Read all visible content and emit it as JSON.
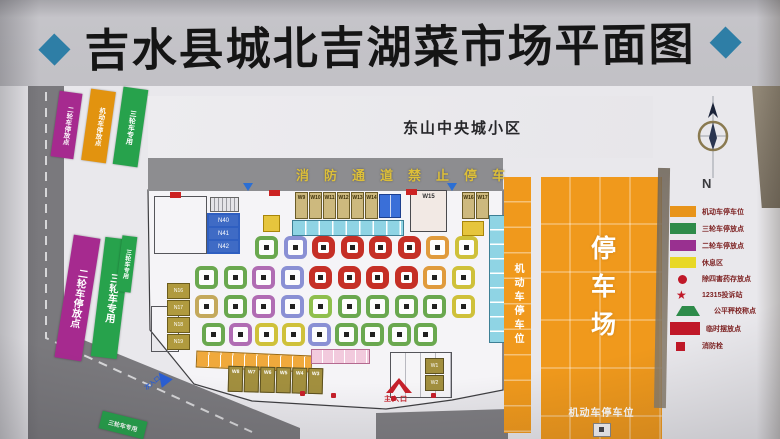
{
  "title": {
    "text": "吉水县城北吉湖菜市场平面图",
    "diamond": "◆"
  },
  "map": {
    "community_label": "东山中央城小区",
    "fire_lane_label": "消防通道禁止停车",
    "north_label": "N",
    "strips_top": [
      {
        "label": "二轮车停放点",
        "color": "#a62a8f"
      },
      {
        "label": "机动车停放点",
        "color": "#e2930f"
      },
      {
        "label": "三轮车专用",
        "color": "#27a24c"
      }
    ],
    "strips_mid": [
      {
        "label": "二轮车停放点",
        "color": "#a62a8f"
      },
      {
        "label": "三轮车专用",
        "color": "#27a24c"
      },
      {
        "label": "三轮车专用",
        "color": "#27a24c"
      }
    ],
    "road_strip_label": "三轮车专用",
    "right_strip_label": "机动车停车位",
    "parking_label": "停车场",
    "parking_bottom_label": "机动车停车位",
    "main_entrance": "主入口",
    "secondary_entrance": "次入口",
    "shops_top": [
      "W9",
      "W10",
      "W11",
      "W12",
      "W13",
      "W14"
    ],
    "room_big": "W15",
    "shops_right": [
      "W16",
      "W17"
    ],
    "block_blue": [
      "N40",
      "N41",
      "N42"
    ],
    "shops_left": [
      "N16",
      "N17",
      "N18",
      "N19"
    ],
    "shops_bottom": [
      "W8",
      "W7",
      "W6",
      "W5",
      "W4",
      "W3"
    ],
    "shops_bottom_right": [
      "W1",
      "W2"
    ]
  },
  "legend": {
    "items": [
      {
        "swatch": "rect",
        "color": "#e8941a",
        "label": "机动车停车位"
      },
      {
        "swatch": "rect",
        "color": "#2e8b4a",
        "label": "三轮车停放点"
      },
      {
        "swatch": "rect",
        "color": "#993090",
        "label": "二轮车停放点"
      },
      {
        "swatch": "rect",
        "color": "#e8d825",
        "label": "休息区"
      },
      {
        "swatch": "circle",
        "color": "#c01828",
        "label": "除四害药存放点"
      },
      {
        "swatch": "star",
        "color": "#c01828",
        "label": "12315投诉站"
      },
      {
        "swatch": "triangle",
        "color": "#2e8b4a",
        "label": "公平秤校称点"
      },
      {
        "swatch": "wide",
        "color": "#c01828",
        "label": "临时摆放点"
      },
      {
        "swatch": "square",
        "color": "#c01828",
        "label": "消防栓"
      }
    ]
  },
  "stalls": {
    "palette": {
      "red": "#c52f26",
      "green": "#6aa84f",
      "teal": "#45b8d0",
      "purple": "#b06cb3",
      "indigo": "#8a90d4",
      "orange": "#e09b3d",
      "gold": "#cfc13a",
      "tan": "#c4a95c",
      "lime": "#8fbf4d"
    },
    "rows": [
      {
        "x0": 255,
        "y": 236,
        "pitch": 28.5,
        "size": 23,
        "cells": [
          "green",
          "indigo",
          "red",
          "red",
          "red",
          "red",
          "orange",
          "gold"
        ]
      },
      {
        "x0": 195,
        "y": 266,
        "pitch": 28.5,
        "size": 23,
        "cells": [
          "green",
          "green",
          "purple",
          "indigo",
          "red",
          "red",
          "red",
          "red",
          "orange",
          "gold"
        ]
      },
      {
        "x0": 195,
        "y": 295,
        "pitch": 28.5,
        "size": 23,
        "cells": [
          "tan",
          "green",
          "purple",
          "indigo",
          "lime",
          "green",
          "green",
          "green",
          "green",
          "gold"
        ]
      },
      {
        "x0": 202,
        "y": 323,
        "pitch": 26.5,
        "size": 23,
        "cells": [
          "green",
          "purple",
          "gold",
          "gold",
          "indigo",
          "green",
          "green",
          "green",
          "green"
        ]
      }
    ]
  }
}
